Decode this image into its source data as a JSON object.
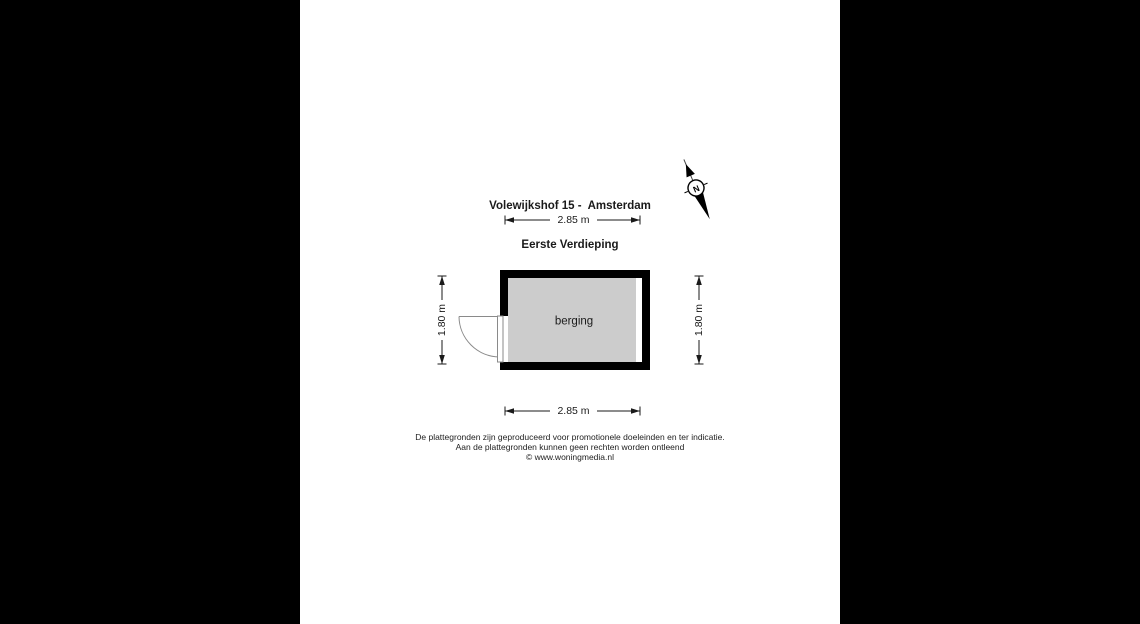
{
  "title": {
    "line1": "Volewijkshof 15 -  Amsterdam",
    "line2": "Eerste Verdieping"
  },
  "compass": {
    "north_label": "N"
  },
  "floor_plan": {
    "room_label": "berging",
    "dim_width_top": "2.85 m",
    "dim_width_bottom": "2.85 m",
    "dim_height_left": "1.80 m",
    "dim_height_right": "1.80 m",
    "colors": {
      "letterbox": "#000000",
      "wall": "#000000",
      "floor_fill": "#cccccc",
      "dim_line": "#1a1a1a",
      "door_stroke": "#8a8a8a"
    }
  },
  "footer": {
    "disclaimer_line1": "De plattegronden zijn geproduceerd voor promotionele doeleinden en ter indicatie.",
    "disclaimer_line2": "Aan de plattegronden kunnen geen rechten worden ontleend",
    "credit": "© www.woningmedia.nl"
  }
}
